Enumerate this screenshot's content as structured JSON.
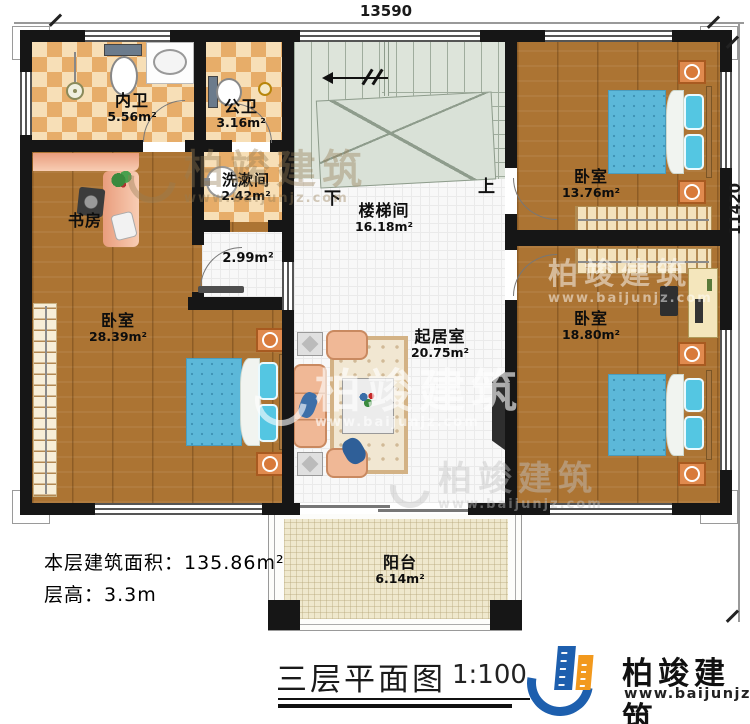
{
  "dimensions": {
    "width_mm": "13590",
    "depth_mm": "11420"
  },
  "rooms": [
    {
      "name": "内卫",
      "area": "5.56m²"
    },
    {
      "name": "公卫",
      "area": "3.16m²"
    },
    {
      "name": "洗漱间",
      "area": "2.42m²"
    },
    {
      "name": "书房",
      "area": ""
    },
    {
      "name": "卧室",
      "area": "28.39m²"
    },
    {
      "name": "楼梯间",
      "area": "16.18m²"
    },
    {
      "name": "卧室",
      "area": "13.76m²"
    },
    {
      "name": "卧室",
      "area": "18.80m²"
    },
    {
      "name": "起居室",
      "area": "20.75m²"
    },
    {
      "name": "阳台",
      "area": "6.14m²"
    },
    {
      "name": "",
      "area": "2.99m²"
    }
  ],
  "stairs": {
    "down_label": "下",
    "up_label": "上"
  },
  "notes": {
    "floor_area": "本层建筑面积：135.86m²",
    "floor_height": "层高：3.3m"
  },
  "title_block": {
    "title": "三层平面图",
    "scale": "1:100"
  },
  "brand": {
    "name": "柏竣建筑",
    "site": "www.baijunjz.com"
  },
  "watermark": {
    "name": "柏竣建筑",
    "site": "www.baijunjz.com"
  }
}
